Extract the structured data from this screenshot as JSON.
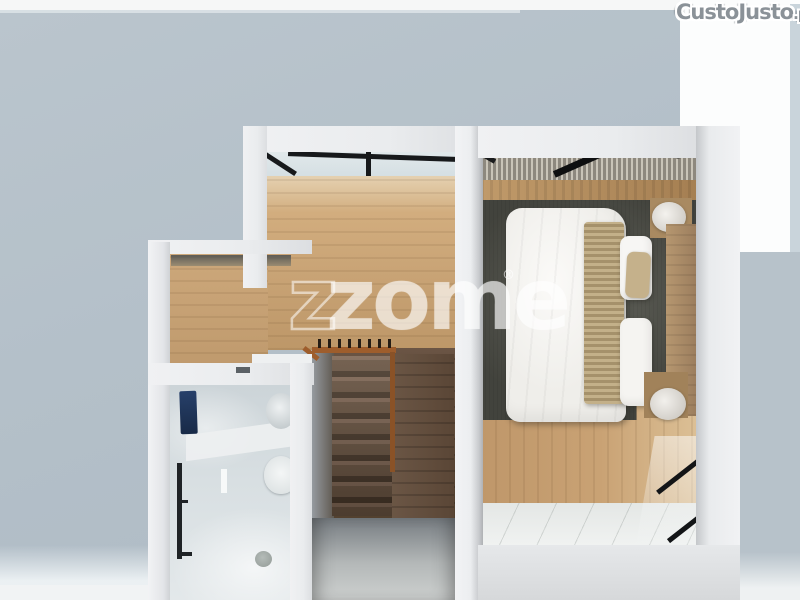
{
  "watermarks": {
    "portal": {
      "name": "CustoJusto",
      "tld": ".pt"
    },
    "agency": {
      "wordmark": "zome",
      "ghost_letter": "z",
      "registered": "®"
    }
  },
  "scene": {
    "kind": "top-down 3D dollhouse render of an apartment floor",
    "rooms": [
      {
        "id": "hall-landing",
        "floor": "light oak wood",
        "features": [
          "black framed window wall"
        ]
      },
      {
        "id": "bedroom",
        "floor": "oak wood with white tile strip",
        "features": [
          "double bed with white duvet",
          "beige throw runner",
          "pillows",
          "wood headboard",
          "two nightstands with round lamps",
          "dark olive area rug",
          "slatted blind band",
          "black framed balcony glazing"
        ]
      },
      {
        "id": "staircase",
        "features": [
          "dark wood steps",
          "orange-brown handrail with balusters",
          "grey lower landing"
        ]
      },
      {
        "id": "bathroom",
        "features": [
          "marble walls",
          "navy towel",
          "black towel rail",
          "washbasin",
          "toilet",
          "floor drain"
        ]
      }
    ],
    "palette": {
      "backdrop": "#b7c2ca",
      "walls": "#eceef0",
      "oak_floor": "#c9a476",
      "stair_wood": "#5d4a3c",
      "rug": "#55564e",
      "bed_linen": "#f3f2ef",
      "towel_navy": "#1e3455",
      "handrail": "#9e5d2c",
      "glass_frame": "#17191b"
    }
  }
}
